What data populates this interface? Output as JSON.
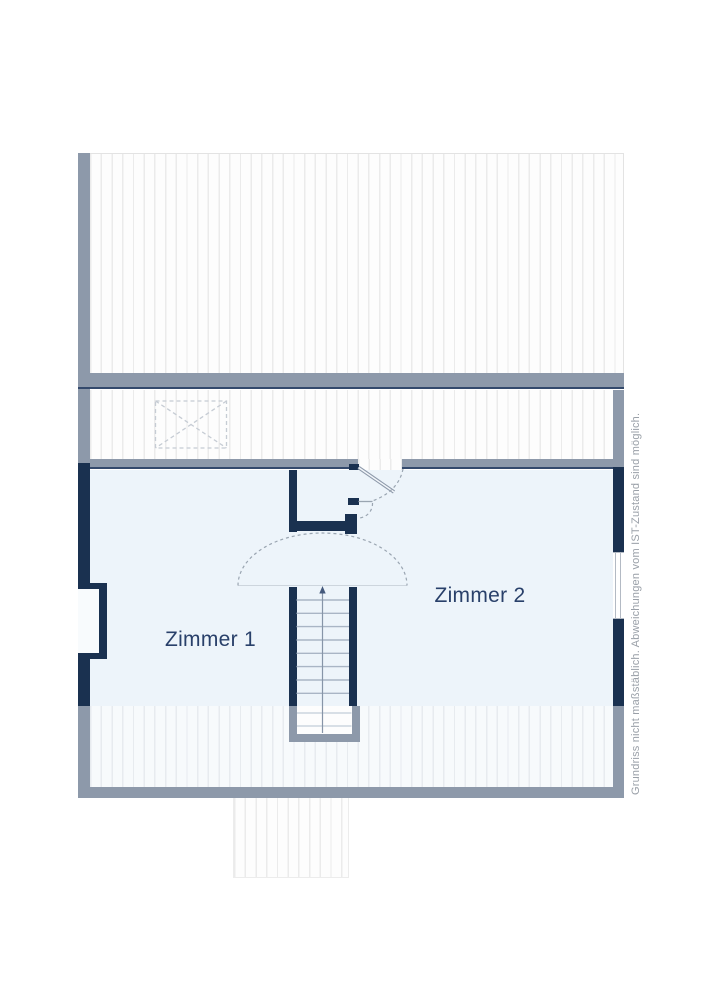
{
  "rooms": [
    {
      "label": "Zimmer 1"
    },
    {
      "label": "Zimmer 2"
    }
  ],
  "disclaimer": "Grundriss nicht maßstäblich. Abweichungen vom IST-Zustand sind möglich.",
  "colors": {
    "wall_dark": "#1a3150",
    "wall_gray": "#8d99aa",
    "edge_dark": "#33496c",
    "floor": "#edf4fa",
    "hatch_line": "#ebebeb",
    "hatch_line_blue": "#e7ebef",
    "strip_bg": "#f7fafc",
    "label_text": "#29406a",
    "disclaimer_text": "#9aa0a8",
    "swing_line": "#9aa5b1",
    "tread_line": "#a9b5c5"
  }
}
